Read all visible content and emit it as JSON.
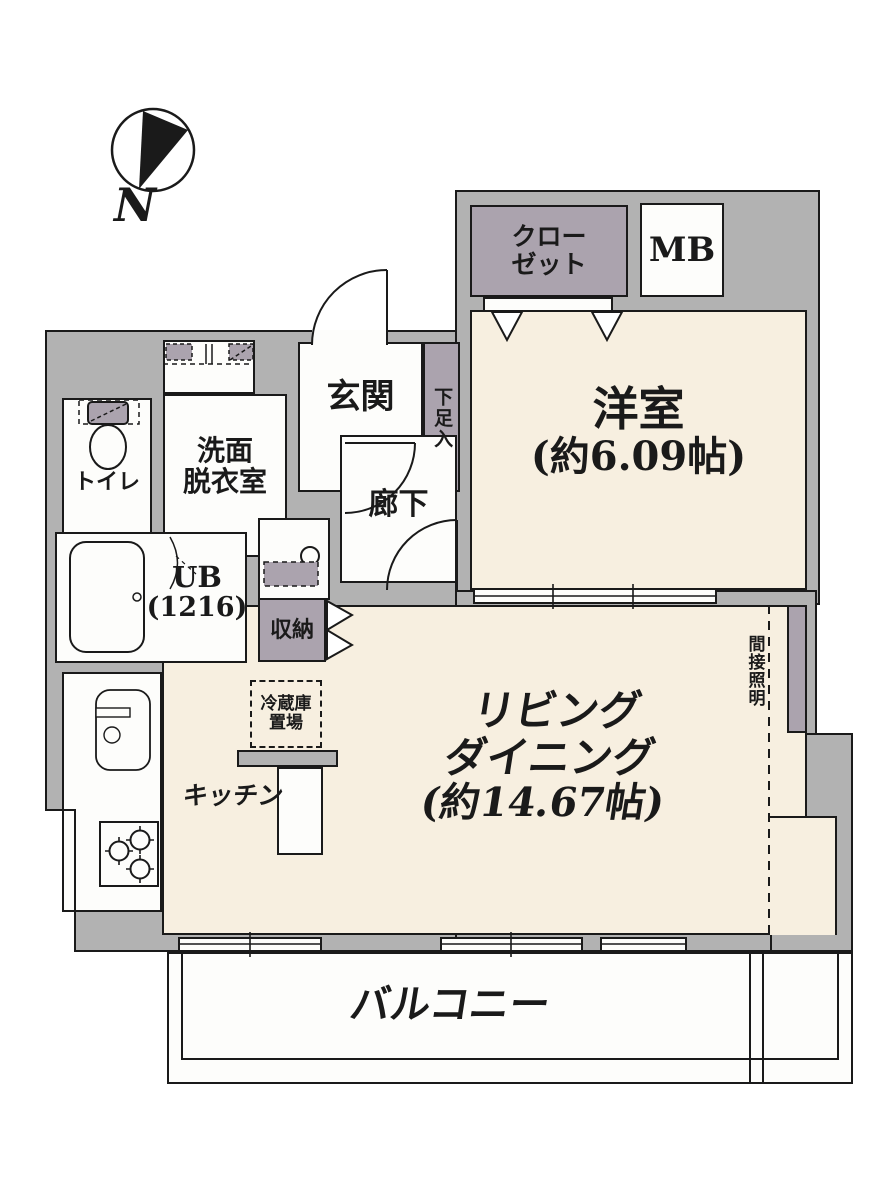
{
  "compass": {
    "north": "N"
  },
  "rooms": {
    "closet": {
      "line1": "クロー",
      "line2": "ゼット"
    },
    "meter_box": {
      "label": "MB"
    },
    "western_room": {
      "name": "洋室",
      "size": "(約6.09帖)"
    },
    "entrance": {
      "label": "玄関"
    },
    "shoe_cabinet": {
      "label": "下足入"
    },
    "corridor": {
      "label": "廊下"
    },
    "toilet": {
      "label": "トイレ"
    },
    "washroom": {
      "line1": "洗面",
      "line2": "脱衣室"
    },
    "unit_bath": {
      "line1": "UB",
      "line2": "(1216)"
    },
    "storage": {
      "label": "収納"
    },
    "living_dining": {
      "line1": "リビング",
      "line2": "ダイニング",
      "line3": "(約14.67帖)"
    },
    "kitchen": {
      "label": "キッチン"
    },
    "refrigerator_space": {
      "line1": "冷蔵庫",
      "line2": "置場"
    },
    "indirect_lighting": {
      "label": "間接照明"
    },
    "balcony": {
      "label": "バルコニー"
    }
  },
  "colors": {
    "wall": "#b2b2b2",
    "floor": "#f7efe0",
    "cabinet": "#aba3ae",
    "line": "#1a1a1a",
    "background": "#ffffff"
  }
}
